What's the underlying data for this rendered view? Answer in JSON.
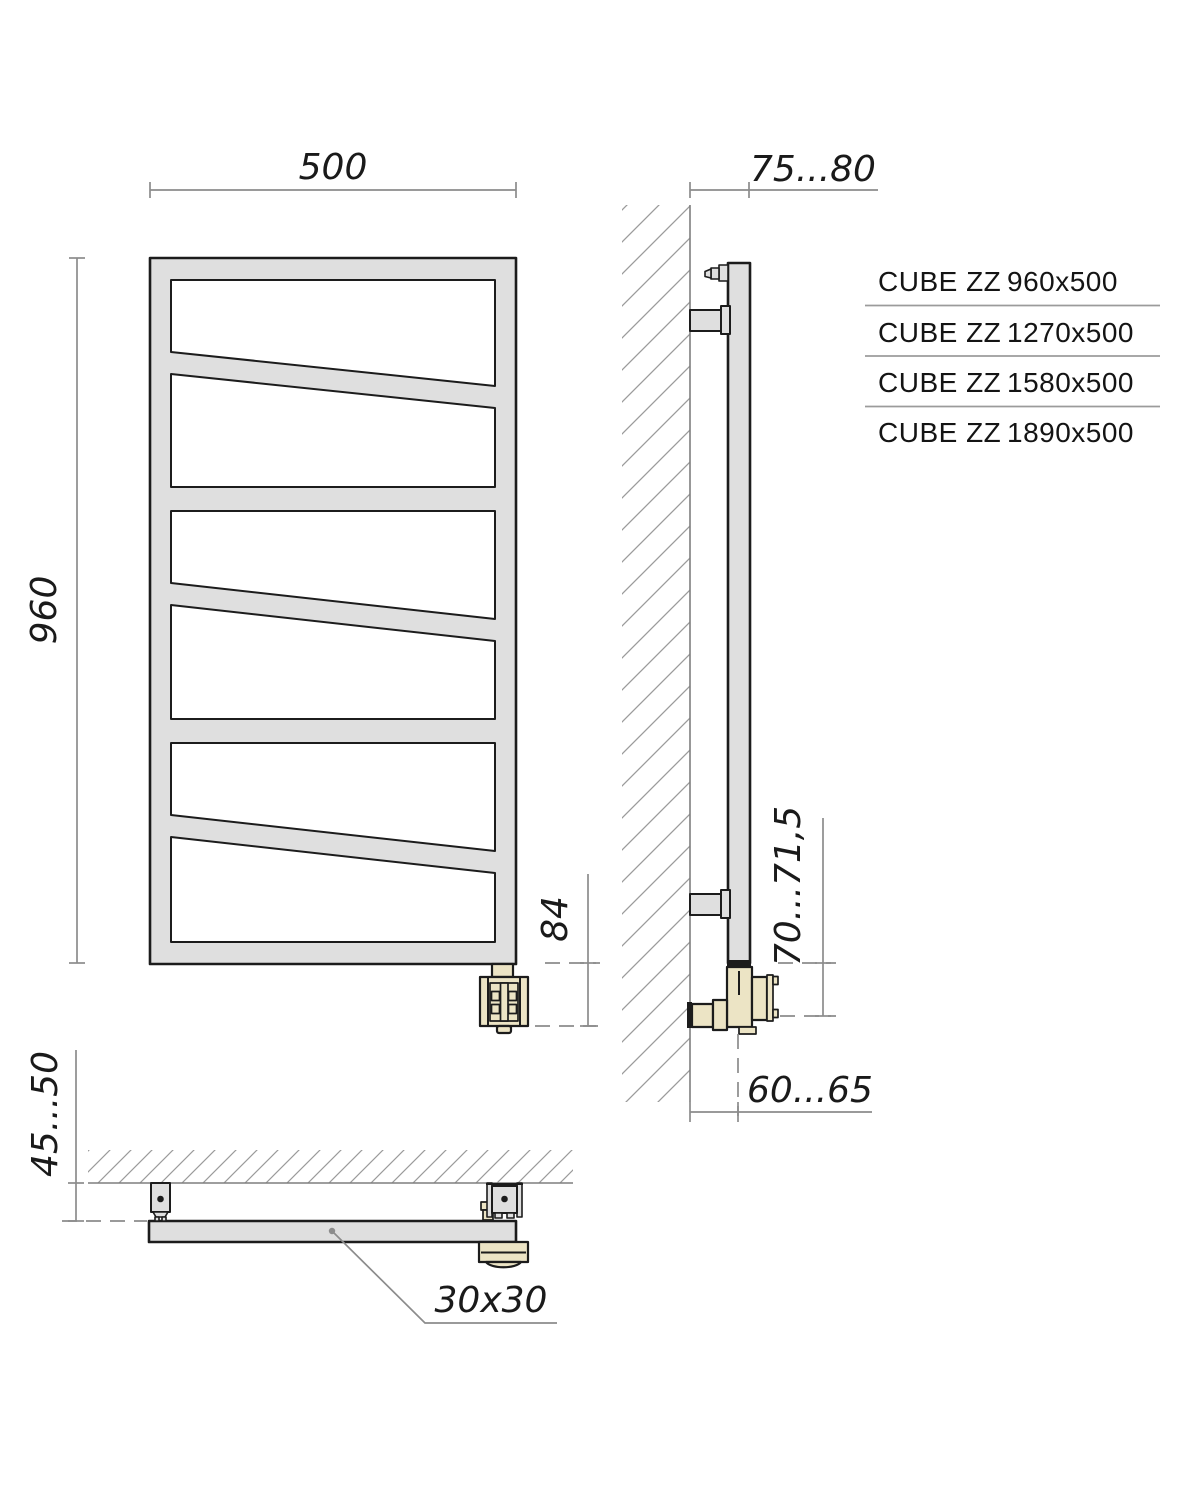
{
  "product_list": {
    "rows": [
      {
        "name": "CUBE ZZ",
        "size": "960x500"
      },
      {
        "name": "CUBE ZZ",
        "size": "1270x500"
      },
      {
        "name": "CUBE ZZ",
        "size": "1580x500"
      },
      {
        "name": "CUBE ZZ",
        "size": "1890x500"
      }
    ]
  },
  "dimensions": {
    "front_width": "500",
    "front_height": "960",
    "valve_drop": "84",
    "wall_to_front": "75...80",
    "bottom_connection_height": "70...71,5",
    "wall_to_connection": "60...65",
    "wall_clearance": "45...50",
    "tube_profile": "30x30"
  },
  "colors": {
    "outline": "#1c1c1c",
    "steel_fill": "#dfdfdf",
    "brass_fill": "#ece4c5",
    "dimension_gray": "#8c8c8c",
    "hatch_gray": "#9b9b9b",
    "background": "#ffffff"
  }
}
